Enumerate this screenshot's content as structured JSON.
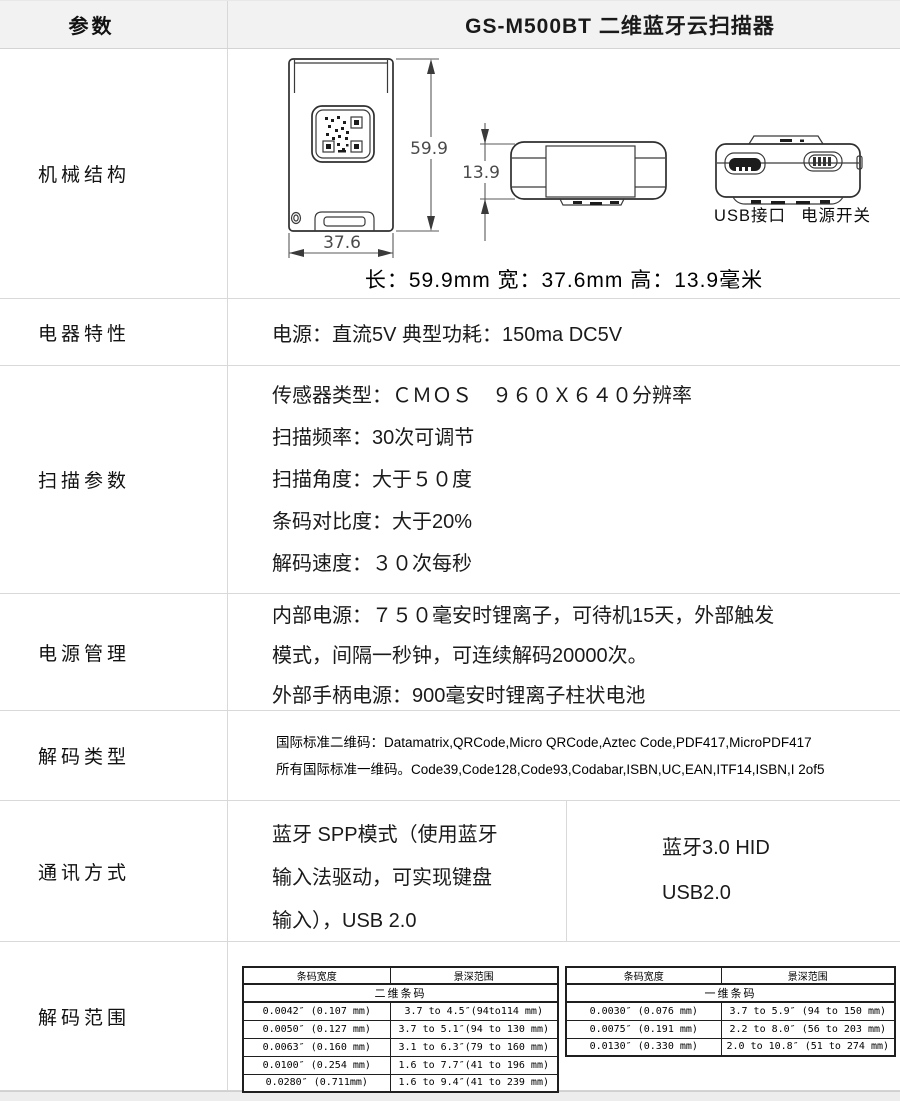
{
  "header": {
    "param_label": "参数",
    "title": "GS-M500BT 二维蓝牙云扫描器"
  },
  "rows": {
    "mechanical": {
      "label": "机械结构",
      "dims": {
        "length": "59.9",
        "width": "37.6",
        "height": "13.9"
      },
      "port_labels": {
        "usb": "USB接口",
        "power": "电源开关"
      },
      "caption": "长：59.9mm  宽：37.6mm  高：13.9毫米"
    },
    "electrical": {
      "label": "电器特性",
      "text": "电源：直流5V  典型功耗：150ma DC5V"
    },
    "scanning": {
      "label": "扫描参数",
      "lines": [
        "传感器类型：ＣＭＯＳ　９６０Ｘ６４０分辨率",
        "扫描频率：30次可调节",
        "扫描角度：大于５０度",
        "条码对比度：大于20%",
        "解码速度：３０次每秒"
      ]
    },
    "power": {
      "label": "电源管理",
      "lines": [
        "内部电源：７５０毫安时锂离子，可待机15天，外部触发",
        "模式，间隔一秒钟，可连续解码20000次。",
        "外部手柄电源：900毫安时锂离子柱状电池"
      ]
    },
    "decode_types": {
      "label": "解码类型",
      "lines": [
        "国际标准二维码：Datamatrix,QRCode,Micro QRCode,Aztec Code,PDF417,MicroPDF417",
        "所有国际标准一维码。Code39,Code128,Code93,Codabar,ISBN,UC,EAN,ITF14,ISBN,I 2of5"
      ]
    },
    "communication": {
      "label": "通讯方式",
      "left_lines": [
        "蓝牙 SPP模式（使用蓝牙",
        "输入法驱动，可实现键盘",
        "输入），USB 2.0"
      ],
      "right_lines": [
        "蓝牙3.0 HID",
        "USB2.0"
      ]
    },
    "decode_range": {
      "label": "解码范围",
      "tables": [
        {
          "headers": [
            "条码宽度",
            "景深范围"
          ],
          "span": "二维条码",
          "rows": [
            [
              "0.0042″ (0.107 mm)",
              "3.7 to 4.5″(94to114 mm)"
            ],
            [
              "0.0050″ (0.127 mm)",
              "3.7 to 5.1″(94 to 130 mm)"
            ],
            [
              "0.0063″ (0.160 mm)",
              "3.1 to 6.3″(79 to 160 mm)"
            ],
            [
              "0.0100″ (0.254 mm)",
              "1.6 to 7.7″(41 to 196 mm)"
            ],
            [
              "0.0280″  (0.711mm)",
              "1.6 to 9.4″(41 to 239 mm)"
            ]
          ]
        },
        {
          "headers": [
            "条码宽度",
            "景深范围"
          ],
          "span": "一维条码",
          "rows": [
            [
              "0.0030″ (0.076 mm)",
              "3.7 to 5.9″ (94 to 150 mm)"
            ],
            [
              "0.0075″ (0.191 mm)",
              "2.2 to 8.0″ (56 to 203 mm)"
            ],
            [
              "0.0130″ (0.330 mm)",
              "2.0 to 10.8″ (51 to 274 mm)"
            ]
          ]
        }
      ]
    }
  },
  "colors": {
    "header_bg": "#f2f2f2",
    "border": "#d9d9d9",
    "table_border": "#1f1f1f"
  }
}
